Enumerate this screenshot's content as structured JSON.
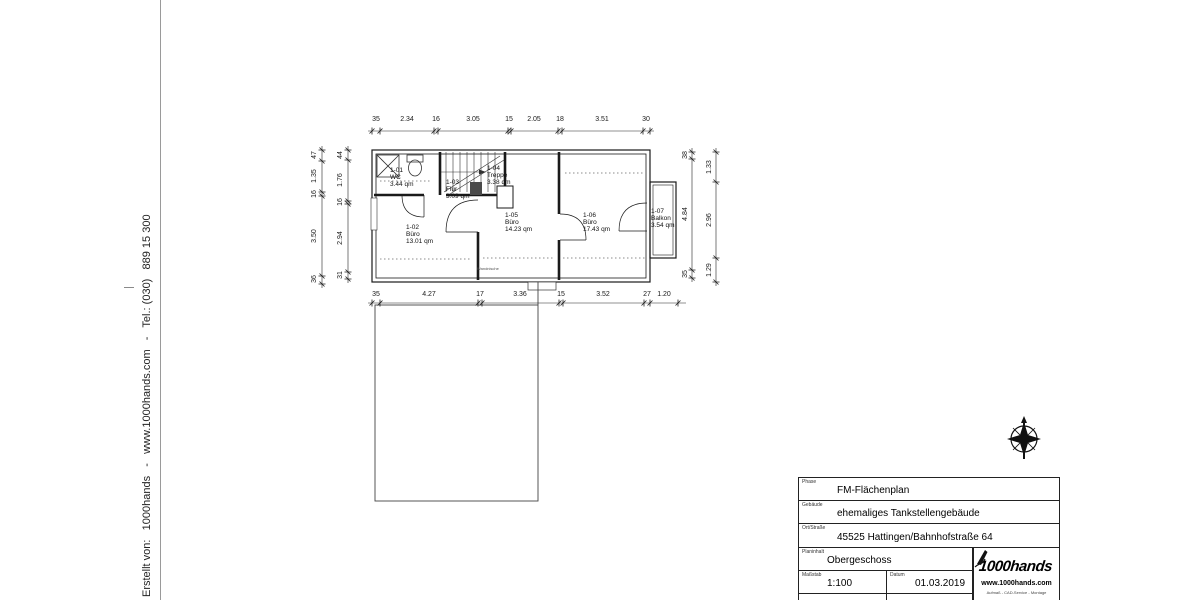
{
  "margin": {
    "credit": "Erstellt von:   1000hands   -   www.1000hands.com   -   Tel.: (030)   889 15 300"
  },
  "plan": {
    "dims_top": [
      "35",
      "2.34",
      "16",
      "3.05",
      "15",
      "2.05",
      "18",
      "3.51",
      "30"
    ],
    "dims_bottom": [
      "35",
      "4.27",
      "17",
      "3.36",
      "15",
      "3.52",
      "27",
      "1.20"
    ],
    "dims_left_outer": [
      "47",
      "1.35",
      "16",
      "3.50",
      "36"
    ],
    "dims_left_inner": [
      "44",
      "1.76",
      "16",
      "2.94",
      "31"
    ],
    "dims_right_inner": [
      "38",
      "4.84",
      "35"
    ],
    "dims_right_outer": [
      "1.33",
      "2.96",
      "1.29"
    ],
    "rooms": [
      {
        "id": "1-01",
        "name": "WC",
        "area": "3.44 qm"
      },
      {
        "id": "1-02",
        "name": "Büro",
        "area": "13.01 qm"
      },
      {
        "id": "1-03",
        "name": "Flur",
        "area": "3.09 qm"
      },
      {
        "id": "1-04",
        "name": "Treppe",
        "area": "3.38 qm"
      },
      {
        "id": "1-05",
        "name": "Büro",
        "area": "14.23 qm"
      },
      {
        "id": "1-06",
        "name": "Büro",
        "area": "17.43 qm"
      },
      {
        "id": "1-07",
        "name": "Balkon",
        "area": "3.54 qm"
      }
    ],
    "note": "Wandnische"
  },
  "titleblock": {
    "rows": [
      {
        "label": "Phase",
        "value": "FM-Flächenplan"
      },
      {
        "label": "Gebäude",
        "value": "ehemaliges Tankstellengebäude"
      },
      {
        "label": "Ort/Straße",
        "value": "45525 Hattingen/Bahnhofstraße 64"
      },
      {
        "label": "Planinhalt",
        "value": "Obergeschoss"
      }
    ],
    "scale_label": "Maßstab",
    "scale_value": "1:100",
    "date_label": "Datum",
    "date_value": "01.03.2019",
    "logo_text": "1000hands",
    "logo_url": "www.1000hands.com",
    "logo_tagline": "Aufmaß - CAD-Service - Montage"
  },
  "icons": {
    "north_arrow": "compass-north-arrow"
  }
}
